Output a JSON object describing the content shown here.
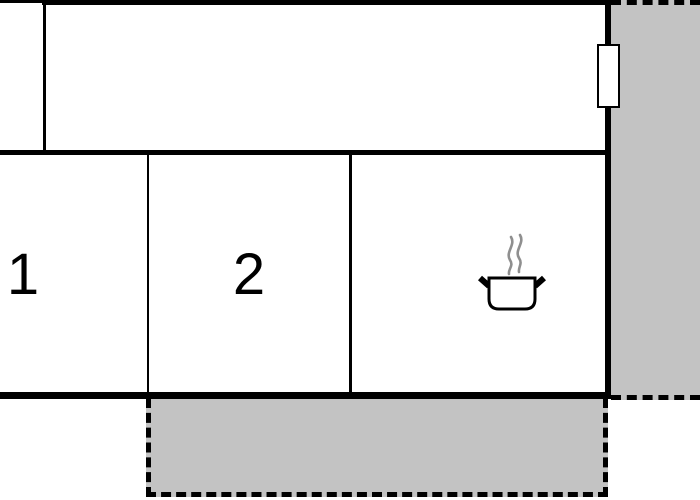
{
  "floorplan": {
    "rooms": [
      {
        "name": "room-left-partial",
        "label": ""
      },
      {
        "name": "room-top",
        "label": ""
      },
      {
        "name": "room-1",
        "label": "1"
      },
      {
        "name": "room-2",
        "label": "2"
      },
      {
        "name": "kitchen",
        "label": "",
        "icon": "cooking-pot-icon"
      }
    ],
    "terraces": [
      {
        "name": "terrace-right",
        "border": "dashed"
      },
      {
        "name": "terrace-bottom",
        "border": "dashed"
      }
    ],
    "window_marker": {
      "name": "window-marker",
      "wall": "right"
    },
    "icons": {
      "cooking_pot": "cooking-pot-icon",
      "steam": "steam-icon"
    },
    "colors": {
      "wall": "#000000",
      "terrace_fill": "#c3c3c3",
      "room_fill": "#ffffff",
      "steam": "#8f8f8f",
      "label": "#000000"
    }
  }
}
